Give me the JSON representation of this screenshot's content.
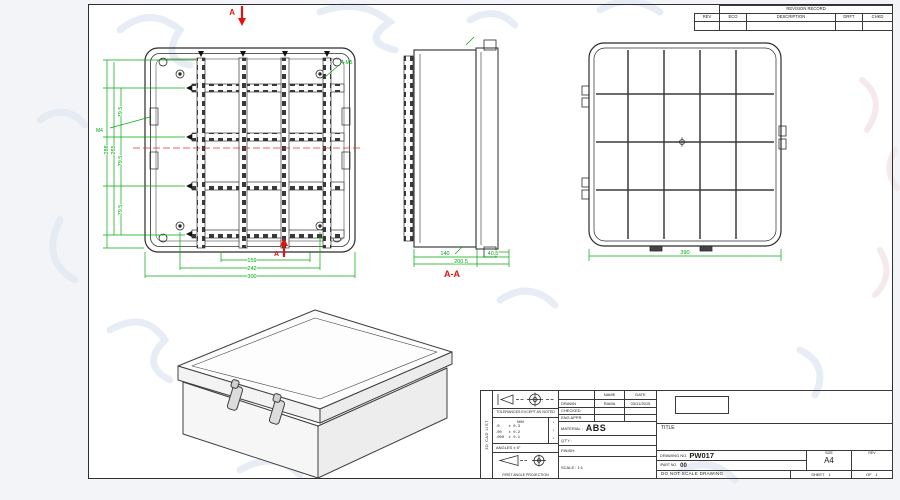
{
  "colors": {
    "dimension": "#00a80a",
    "section": "#e01212",
    "line": "#2c2c2c"
  },
  "revision_table": {
    "title": "REVISION RECORD",
    "col_rev": "REV",
    "col_eco": "ECO",
    "col_description": "DESCRIPTION",
    "col_drft": "DRFT",
    "col_chkd": "CHKD"
  },
  "front_view": {
    "section_letter": "A",
    "callout_corner_screws": "4-M5",
    "callout_latch_screw": "M4",
    "dim_rail_spacing": "79.5",
    "dim_stack_outer": "288",
    "dim_stack_mid": "265",
    "dim_bottom_inner": "159",
    "dim_bottom_mid": "242",
    "dim_bottom_outer": "300"
  },
  "side_view": {
    "section_label": "A-A",
    "dim_body_depth": "140",
    "dim_total_depth": "200.5",
    "dim_lid_depth": "40.5"
  },
  "back_view": {
    "dim_width": "390"
  },
  "title_block": {
    "edge_label": "3D CAD LIST",
    "tolerance_note": "TOLERANCES EXCEPT AS NOTED",
    "units_label": "MM",
    "tolerance_rows": [
      ".0    ± 0.3",
      ".00   ± 0.2",
      ".000  ± 0.1"
    ],
    "tolerance_marks": [
      "▪",
      "▪",
      "▪"
    ],
    "angles_note": "ANGLES ± 5°",
    "projection_note": "FIRST ANGLE PROJECTION",
    "name_header": "NAME",
    "date_header": "DATE",
    "drawn_label": "DRAWN",
    "drawn_name": "RAMA",
    "drawn_date": "03/11/2015",
    "checked_label": "CHECKED",
    "eng_appr_label": "ENG APPR",
    "material_label": "MATERIAL :",
    "material_value": "ABS",
    "qty_label": "QT'Y :",
    "finish_label": "FINISH:",
    "scale_label": "SCALE : 1:1",
    "title_label": "TITLE",
    "drawing_no_label": "DRAWING NO.",
    "drawing_no_value": "PW017",
    "part_no_label": "/PART  NO.",
    "part_no_value": "00",
    "size_label": "SIZE",
    "size_value": "A4",
    "rev_label": "REV",
    "do_not_scale": "DO NOT SCALE DRAWING",
    "sheet_label": "SHEET",
    "sheet_value": "1",
    "of_label": "OF",
    "of_value": "1"
  }
}
